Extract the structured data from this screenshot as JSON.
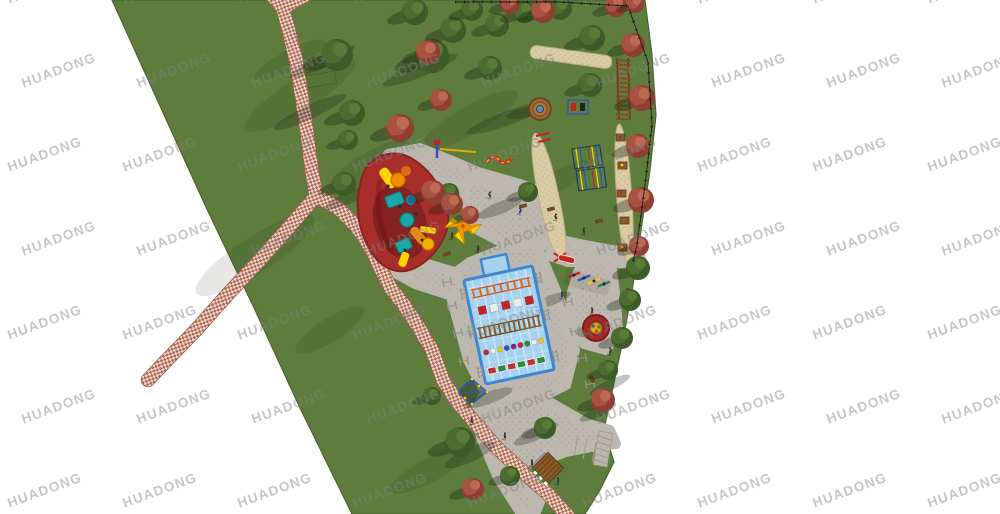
{
  "watermark": {
    "text": "HUADONG",
    "font_size": 13.5,
    "letter_spacing": 1.2,
    "rotation_deg": -20,
    "color": "rgba(128,128,128,0.45)",
    "grid": {
      "x0": 8,
      "y0": -8,
      "dx": 115,
      "dy": 84,
      "cols": 9,
      "rows": 7,
      "odd_row_offset": 14
    }
  },
  "palette": {
    "background": "#ffffff",
    "lawn": "#5e7d3d",
    "lawn_edge": "#49662e",
    "plaza": "#bdb8af",
    "plaza_dot": "#b0aba1",
    "plaza_line": "#a09b90",
    "sand": "#d9cba3",
    "sand_dot": "#c6b588",
    "brick_a": "#b26457",
    "brick_b": "#e9dcc9",
    "brick_edge": "#9c5a4e",
    "pool_water": "#a6d2ef",
    "pool_border": "#3f86d2",
    "pool_lane": "#c9e7fa",
    "pad_red": "#a82e2c",
    "pad_red_edge": "#8c2220",
    "tree_green_dark": "#3e5a28",
    "tree_green_mid": "#4c6c30",
    "tree_green_light": "#587b38",
    "tree_red_dark": "#8e3f32",
    "tree_red_mid": "#a85242",
    "tree_red_light": "#bd6a52",
    "shadow": "rgba(25,38,16,0.35)",
    "cast_shadow": "rgba(28,38,20,0.28)",
    "equip_orange": "#f08c00",
    "equip_orange_deep": "#e06a18",
    "equip_teal": "#18a8a8",
    "equip_teal_edge": "#0d7878",
    "equip_yellow": "#ffd400",
    "equip_navy": "#14284a",
    "equip_red": "#c42424",
    "equip_blue": "#2a52c8",
    "equip_green": "#2a8a3a",
    "wood": "#8a5a2a",
    "wood_dark": "#5f3c16",
    "fence": "#1d1d1d",
    "gray_frame": "#8f958f",
    "figure": "#2e2e2e"
  },
  "scene": {
    "park_outline": [
      [
        112,
        0
      ],
      [
        645,
        0
      ],
      [
        652,
        55
      ],
      [
        656,
        115
      ],
      [
        650,
        170
      ],
      [
        641,
        230
      ],
      [
        633,
        285
      ],
      [
        624,
        335
      ],
      [
        612,
        392
      ],
      [
        604,
        430
      ],
      [
        614,
        462
      ],
      [
        600,
        490
      ],
      [
        585,
        514
      ],
      [
        352,
        514
      ],
      [
        300,
        408
      ],
      [
        255,
        310
      ],
      [
        205,
        205
      ],
      [
        155,
        95
      ]
    ],
    "lawn_shade": [
      [
        300,
        95,
        65,
        16,
        -32
      ],
      [
        370,
        165,
        45,
        13,
        -30
      ],
      [
        255,
        255,
        70,
        18,
        -33
      ],
      [
        470,
        120,
        55,
        14,
        -30
      ],
      [
        330,
        330,
        40,
        12,
        -32
      ],
      [
        430,
        470,
        45,
        12,
        -28
      ],
      [
        560,
        180,
        35,
        10,
        -30
      ],
      [
        290,
        60,
        40,
        10,
        -28
      ]
    ],
    "cast_shadows": [
      [
        310,
        112,
        40,
        7,
        -25
      ],
      [
        322,
        62,
        36,
        6,
        -25
      ],
      [
        508,
        118,
        44,
        7,
        -20
      ],
      [
        420,
        70,
        40,
        7,
        -22
      ],
      [
        352,
        196,
        30,
        6,
        -25
      ],
      [
        610,
        385,
        22,
        5,
        -25
      ],
      [
        536,
        434,
        24,
        6,
        -25
      ],
      [
        470,
        455,
        28,
        7,
        -25
      ],
      [
        598,
        412,
        20,
        5,
        -25
      ],
      [
        488,
        398,
        26,
        6,
        -20
      ],
      [
        552,
        300,
        20,
        5,
        -20
      ],
      [
        500,
        208,
        24,
        6,
        -22
      ]
    ],
    "plaza_blobs": [
      [
        [
          388,
          154
        ],
        [
          420,
          148
        ],
        [
          450,
          160
        ],
        [
          478,
          172
        ],
        [
          520,
          184
        ],
        [
          543,
          192
        ],
        [
          548,
          202
        ],
        [
          530,
          206
        ],
        [
          492,
          196
        ],
        [
          455,
          186
        ],
        [
          418,
          174
        ],
        [
          392,
          166
        ]
      ],
      [
        [
          470,
          178
        ],
        [
          515,
          190
        ],
        [
          545,
          202
        ],
        [
          558,
          222
        ],
        [
          558,
          240
        ],
        [
          536,
          248
        ],
        [
          505,
          244
        ],
        [
          478,
          230
        ],
        [
          465,
          205
        ],
        [
          464,
          188
        ]
      ],
      [
        [
          552,
          238
        ],
        [
          580,
          244
        ],
        [
          612,
          250
        ],
        [
          635,
          252
        ],
        [
          641,
          258
        ],
        [
          630,
          264
        ],
        [
          600,
          262
        ],
        [
          568,
          262
        ],
        [
          550,
          256
        ]
      ],
      [
        [
          536,
          243
        ],
        [
          560,
          300
        ],
        [
          575,
          350
        ],
        [
          566,
          385
        ],
        [
          540,
          398
        ],
        [
          488,
          398
        ],
        [
          468,
          360
        ],
        [
          452,
          300
        ],
        [
          448,
          278
        ],
        [
          470,
          262
        ],
        [
          505,
          248
        ]
      ],
      [
        [
          500,
          396
        ],
        [
          540,
          396
        ],
        [
          560,
          408
        ],
        [
          588,
          424
        ],
        [
          610,
          430
        ],
        [
          616,
          444
        ],
        [
          596,
          446
        ],
        [
          566,
          452
        ],
        [
          540,
          462
        ],
        [
          524,
          486
        ],
        [
          540,
          502
        ],
        [
          536,
          512
        ],
        [
          520,
          512
        ],
        [
          498,
          478
        ],
        [
          482,
          440
        ],
        [
          474,
          412
        ],
        [
          482,
          398
        ]
      ],
      [
        [
          584,
          262
        ],
        [
          604,
          258
        ],
        [
          612,
          270
        ],
        [
          616,
          300
        ],
        [
          618,
          330
        ],
        [
          606,
          350
        ],
        [
          584,
          344
        ],
        [
          570,
          320
        ],
        [
          572,
          292
        ],
        [
          578,
          272
        ]
      ],
      [
        [
          382,
          252
        ],
        [
          420,
          262
        ],
        [
          455,
          272
        ],
        [
          468,
          290
        ],
        [
          452,
          296
        ],
        [
          415,
          284
        ],
        [
          386,
          268
        ]
      ]
    ],
    "plaza_joints": [
      [
        578,
        436,
        574,
        456
      ],
      [
        587,
        439,
        583,
        459
      ],
      [
        596,
        442,
        592,
        462
      ],
      [
        605,
        445,
        601,
        465
      ]
    ],
    "paths": {
      "width": 13,
      "segments": [
        [
          [
            271,
            -6
          ],
          [
            283,
            8
          ]
        ],
        [
          [
            307,
            -6
          ],
          [
            283,
            8
          ]
        ],
        [
          [
            283,
            8
          ],
          [
            296,
            60
          ],
          [
            305,
            118
          ],
          [
            311,
            165
          ],
          [
            316,
            196
          ]
        ],
        [
          [
            316,
            196
          ],
          [
            290,
            226
          ],
          [
            258,
            262
          ],
          [
            228,
            294
          ],
          [
            196,
            330
          ],
          [
            165,
            362
          ],
          [
            148,
            380
          ]
        ],
        [
          [
            316,
            196
          ],
          [
            338,
            208
          ],
          [
            356,
            226
          ],
          [
            369,
            245
          ],
          [
            379,
            265
          ],
          [
            390,
            287
          ],
          [
            404,
            305
          ],
          [
            418,
            326
          ],
          [
            432,
            350
          ],
          [
            443,
            380
          ],
          [
            458,
            403
          ],
          [
            476,
            424
          ],
          [
            497,
            448
          ],
          [
            522,
            471
          ],
          [
            548,
            494
          ],
          [
            568,
            516
          ]
        ]
      ]
    },
    "sand_strips": [
      {
        "cx": 571,
        "cy": 57,
        "w": 82,
        "h": 13,
        "rot": 8
      },
      {
        "cx": 549,
        "cy": 198,
        "w": 20,
        "h": 132,
        "rot": -12
      },
      {
        "cx": 624,
        "cy": 194,
        "w": 15,
        "h": 140,
        "rot": -4
      }
    ],
    "pool": {
      "cx": 509,
      "cy": 325,
      "w": 70,
      "h": 106,
      "rot": -12,
      "bump": [
        -14,
        -70,
        26,
        17
      ],
      "ball_colors": [
        "#cc2424",
        "#f0f0f0",
        "#f2c80a",
        "#2a52c8",
        "#7a2890",
        "#cc2424",
        "#2a8a3a",
        "#f0f0f0",
        "#f2c80a"
      ]
    },
    "red_pad_path": "M370,163 C382,152 400,150 414,160 C430,170 446,192 448,214 C450,235 436,255 420,265 C404,276 386,272 374,256 C362,240 356,218 358,196 C360,180 364,169 370,163 Z",
    "spinner": {
      "cx": 596,
      "cy": 328,
      "r": 13
    },
    "canopy": {
      "cx": 463,
      "cy": 226,
      "half": 13,
      "rot": 40
    },
    "round_platform": {
      "cx": 540,
      "cy": 109,
      "r": 11
    },
    "kiosk": {
      "cx": 548,
      "cy": 468,
      "half": 11,
      "rot": 45
    },
    "net_climber": {
      "cx": 472,
      "cy": 392
    },
    "monkey_grids": [
      [
        572,
        149,
        28,
        20,
        -8
      ],
      [
        576,
        171,
        28,
        20,
        -8
      ]
    ],
    "ground_ladder": {
      "x": 616,
      "y": 58,
      "w": 12,
      "h": 62
    },
    "trail_stations": [
      [
        620,
        137
      ],
      [
        622,
        165
      ],
      [
        621,
        193
      ],
      [
        624,
        220
      ],
      [
        622,
        247
      ]
    ],
    "gray_frames": [
      [
        447,
        282
      ],
      [
        452,
        306
      ],
      [
        458,
        333
      ],
      [
        464,
        361
      ],
      [
        568,
        302
      ],
      [
        575,
        331
      ],
      [
        582,
        358
      ],
      [
        590,
        384
      ]
    ],
    "seesaws": {
      "x": 568,
      "y": 272,
      "colors": [
        "#c42424",
        "#2a52c8",
        "#f2c80a",
        "#2a8a3a"
      ]
    },
    "benches": [
      [
        523,
        206,
        -15
      ],
      [
        551,
        209,
        -15
      ],
      [
        599,
        221,
        -15
      ],
      [
        628,
        292,
        75
      ],
      [
        592,
        379,
        60
      ],
      [
        447,
        254,
        -20
      ]
    ],
    "figures": [
      [
        490,
        196
      ],
      [
        468,
        214
      ],
      [
        452,
        237
      ],
      [
        478,
        250
      ],
      [
        520,
        212
      ],
      [
        556,
        218
      ],
      [
        584,
        232
      ],
      [
        562,
        296
      ],
      [
        592,
        312
      ],
      [
        610,
        352
      ],
      [
        472,
        422
      ],
      [
        505,
        437
      ],
      [
        532,
        464
      ],
      [
        558,
        482
      ]
    ],
    "trees_green": [
      [
        337,
        55,
        16
      ],
      [
        352,
        113,
        13
      ],
      [
        348,
        140,
        10
      ],
      [
        344,
        184,
        12
      ],
      [
        415,
        12,
        13
      ],
      [
        432,
        56,
        17
      ],
      [
        453,
        30,
        13
      ],
      [
        472,
        10,
        11
      ],
      [
        497,
        25,
        12
      ],
      [
        490,
        68,
        12
      ],
      [
        524,
        12,
        11
      ],
      [
        560,
        8,
        12
      ],
      [
        592,
        38,
        13
      ],
      [
        590,
        85,
        12
      ],
      [
        528,
        192,
        10
      ],
      [
        449,
        193,
        10
      ],
      [
        638,
        268,
        12
      ],
      [
        630,
        300,
        11
      ],
      [
        622,
        338,
        11
      ],
      [
        608,
        370,
        10
      ],
      [
        460,
        442,
        15
      ],
      [
        545,
        428,
        11
      ],
      [
        432,
        396,
        9
      ],
      [
        510,
        476,
        10
      ]
    ],
    "trees_red": [
      [
        510,
        4,
        10
      ],
      [
        543,
        11,
        12
      ],
      [
        616,
        6,
        11
      ],
      [
        635,
        4,
        9
      ],
      [
        428,
        52,
        12
      ],
      [
        441,
        100,
        11
      ],
      [
        400,
        128,
        14
      ],
      [
        433,
        192,
        12
      ],
      [
        452,
        204,
        11
      ],
      [
        470,
        215,
        9
      ],
      [
        633,
        45,
        12
      ],
      [
        642,
        98,
        13
      ],
      [
        638,
        146,
        12
      ],
      [
        641,
        200,
        13
      ],
      [
        639,
        246,
        10
      ],
      [
        603,
        400,
        12
      ],
      [
        473,
        489,
        11
      ]
    ],
    "fence": [
      [
        455,
        2
      ],
      [
        560,
        2
      ],
      [
        628,
        6
      ],
      [
        648,
        62
      ],
      [
        652,
        125
      ],
      [
        645,
        185
      ],
      [
        637,
        245
      ],
      [
        633,
        262
      ]
    ],
    "west_net": [
      295,
      78,
      40,
      12
    ]
  }
}
